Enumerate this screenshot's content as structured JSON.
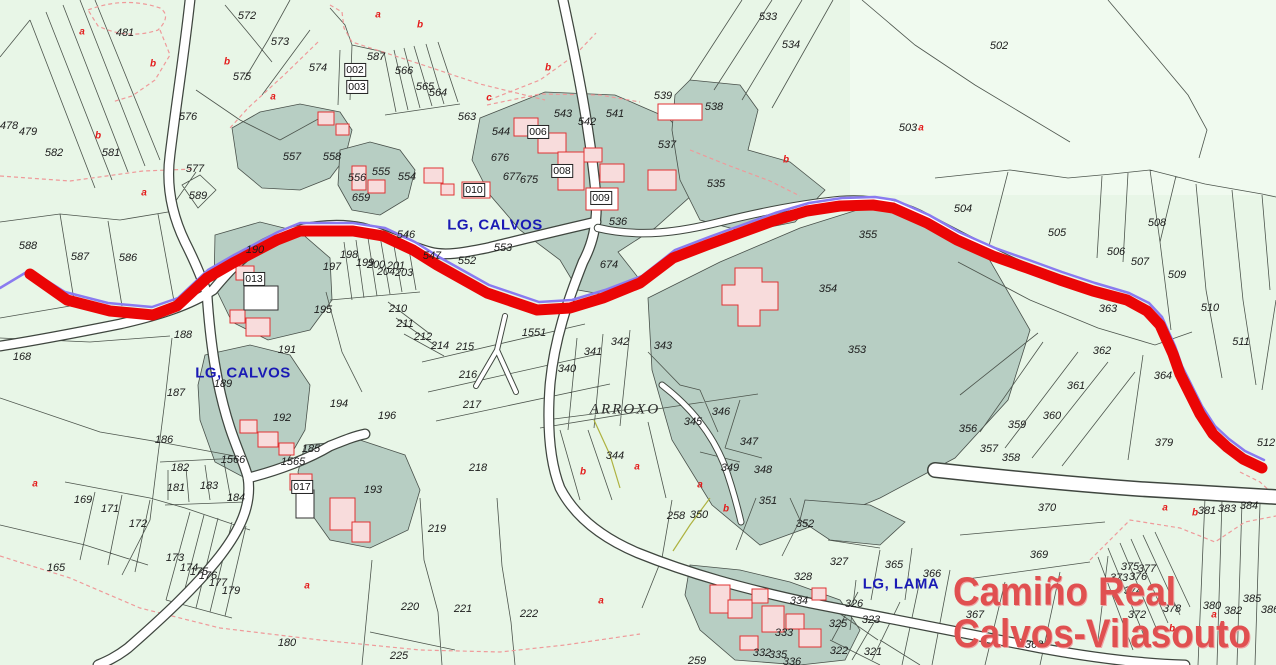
{
  "map": {
    "colors": {
      "background": "#e8f6e7",
      "parcel_shade": "#b7cec3",
      "building_fill": "#f8dcdc",
      "building_stroke": "#e03333",
      "route_red": "#eb0505",
      "route_purple": "#8a7bf0",
      "label_blue": "#1a1ab5",
      "title_red": "#e05050",
      "boundary": "#4d554d"
    },
    "title": {
      "line1": "Camiño Real",
      "line2": "Calvos-Vilasouto"
    },
    "labels": [
      {
        "t": "572",
        "x": 247,
        "y": 16,
        "k": "n"
      },
      {
        "t": "573",
        "x": 280,
        "y": 42,
        "k": "n"
      },
      {
        "t": "574",
        "x": 318,
        "y": 68,
        "k": "n"
      },
      {
        "t": "575",
        "x": 242,
        "y": 77,
        "k": "n"
      },
      {
        "t": "576",
        "x": 188,
        "y": 117,
        "k": "n"
      },
      {
        "t": "577",
        "x": 195,
        "y": 169,
        "k": "n"
      },
      {
        "t": "481",
        "x": 125,
        "y": 33,
        "k": "n"
      },
      {
        "t": "478",
        "x": 9,
        "y": 126,
        "k": "n"
      },
      {
        "t": "479",
        "x": 28,
        "y": 132,
        "k": "n"
      },
      {
        "t": "582",
        "x": 54,
        "y": 153,
        "k": "n"
      },
      {
        "t": "581",
        "x": 111,
        "y": 153,
        "k": "n"
      },
      {
        "t": "557",
        "x": 292,
        "y": 157,
        "k": "n"
      },
      {
        "t": "558",
        "x": 332,
        "y": 157,
        "k": "n"
      },
      {
        "t": "587",
        "x": 376,
        "y": 57,
        "k": "n"
      },
      {
        "t": "002",
        "x": 355,
        "y": 70,
        "k": "bx"
      },
      {
        "t": "003",
        "x": 357,
        "y": 87,
        "k": "bx"
      },
      {
        "t": "566",
        "x": 404,
        "y": 71,
        "k": "n"
      },
      {
        "t": "565",
        "x": 425,
        "y": 87,
        "k": "n"
      },
      {
        "t": "564",
        "x": 438,
        "y": 93,
        "k": "n"
      },
      {
        "t": "563",
        "x": 467,
        "y": 117,
        "k": "n"
      },
      {
        "t": "544",
        "x": 501,
        "y": 132,
        "k": "n"
      },
      {
        "t": "006",
        "x": 538,
        "y": 132,
        "k": "bx"
      },
      {
        "t": "543",
        "x": 563,
        "y": 114,
        "k": "n"
      },
      {
        "t": "542",
        "x": 587,
        "y": 122,
        "k": "n"
      },
      {
        "t": "541",
        "x": 615,
        "y": 114,
        "k": "n"
      },
      {
        "t": "539",
        "x": 663,
        "y": 96,
        "k": "n"
      },
      {
        "t": "538",
        "x": 714,
        "y": 107,
        "k": "n"
      },
      {
        "t": "537",
        "x": 667,
        "y": 145,
        "k": "n"
      },
      {
        "t": "533",
        "x": 768,
        "y": 17,
        "k": "n"
      },
      {
        "t": "534",
        "x": 791,
        "y": 45,
        "k": "n"
      },
      {
        "t": "503",
        "x": 908,
        "y": 128,
        "k": "n"
      },
      {
        "t": "502",
        "x": 999,
        "y": 46,
        "k": "n"
      },
      {
        "t": "535",
        "x": 716,
        "y": 184,
        "k": "n"
      },
      {
        "t": "536",
        "x": 618,
        "y": 222,
        "k": "n"
      },
      {
        "t": "676",
        "x": 500,
        "y": 158,
        "k": "n"
      },
      {
        "t": "677",
        "x": 512,
        "y": 177,
        "k": "n"
      },
      {
        "t": "675",
        "x": 529,
        "y": 180,
        "k": "n"
      },
      {
        "t": "008",
        "x": 562,
        "y": 171,
        "k": "bx"
      },
      {
        "t": "009",
        "x": 601,
        "y": 198,
        "k": "bx"
      },
      {
        "t": "010",
        "x": 474,
        "y": 190,
        "k": "bx"
      },
      {
        "t": "556",
        "x": 357,
        "y": 178,
        "k": "n"
      },
      {
        "t": "555",
        "x": 381,
        "y": 172,
        "k": "n"
      },
      {
        "t": "554",
        "x": 407,
        "y": 177,
        "k": "n"
      },
      {
        "t": "659",
        "x": 361,
        "y": 198,
        "k": "n"
      },
      {
        "t": "589",
        "x": 198,
        "y": 196,
        "k": "n"
      },
      {
        "t": "588",
        "x": 28,
        "y": 246,
        "k": "n"
      },
      {
        "t": "587",
        "x": 80,
        "y": 257,
        "k": "n"
      },
      {
        "t": "586",
        "x": 128,
        "y": 258,
        "k": "n"
      },
      {
        "t": "190",
        "x": 255,
        "y": 250,
        "k": "n"
      },
      {
        "t": "013",
        "x": 254,
        "y": 279,
        "k": "bx"
      },
      {
        "t": "546",
        "x": 406,
        "y": 235,
        "k": "n"
      },
      {
        "t": "553",
        "x": 503,
        "y": 248,
        "k": "n"
      },
      {
        "t": "547",
        "x": 432,
        "y": 256,
        "k": "n"
      },
      {
        "t": "552",
        "x": 467,
        "y": 261,
        "k": "n"
      },
      {
        "t": "198",
        "x": 349,
        "y": 255,
        "k": "n"
      },
      {
        "t": "199",
        "x": 365,
        "y": 263,
        "k": "n"
      },
      {
        "t": "200",
        "x": 376,
        "y": 265,
        "k": "n"
      },
      {
        "t": "201",
        "x": 396,
        "y": 266,
        "k": "n"
      },
      {
        "t": "204",
        "x": 386,
        "y": 272,
        "k": "n"
      },
      {
        "t": "203",
        "x": 404,
        "y": 273,
        "k": "n"
      },
      {
        "t": "197",
        "x": 332,
        "y": 267,
        "k": "n"
      },
      {
        "t": "195",
        "x": 323,
        "y": 310,
        "k": "n"
      },
      {
        "t": "674",
        "x": 609,
        "y": 265,
        "k": "n"
      },
      {
        "t": "355",
        "x": 868,
        "y": 235,
        "k": "n"
      },
      {
        "t": "354",
        "x": 828,
        "y": 289,
        "k": "n"
      },
      {
        "t": "504",
        "x": 963,
        "y": 209,
        "k": "n"
      },
      {
        "t": "505",
        "x": 1057,
        "y": 233,
        "k": "n"
      },
      {
        "t": "506",
        "x": 1116,
        "y": 252,
        "k": "n"
      },
      {
        "t": "507",
        "x": 1140,
        "y": 262,
        "k": "n"
      },
      {
        "t": "508",
        "x": 1157,
        "y": 223,
        "k": "n"
      },
      {
        "t": "509",
        "x": 1177,
        "y": 275,
        "k": "n"
      },
      {
        "t": "510",
        "x": 1210,
        "y": 308,
        "k": "n"
      },
      {
        "t": "511",
        "x": 1241,
        "y": 342,
        "k": "n"
      },
      {
        "t": "512",
        "x": 1266,
        "y": 443,
        "k": "n"
      },
      {
        "t": "363",
        "x": 1108,
        "y": 309,
        "k": "n"
      },
      {
        "t": "364",
        "x": 1163,
        "y": 376,
        "k": "n"
      },
      {
        "t": "362",
        "x": 1102,
        "y": 351,
        "k": "n"
      },
      {
        "t": "361",
        "x": 1076,
        "y": 386,
        "k": "n"
      },
      {
        "t": "360",
        "x": 1052,
        "y": 416,
        "k": "n"
      },
      {
        "t": "359",
        "x": 1017,
        "y": 425,
        "k": "n"
      },
      {
        "t": "356",
        "x": 968,
        "y": 429,
        "k": "n"
      },
      {
        "t": "357",
        "x": 989,
        "y": 449,
        "k": "n"
      },
      {
        "t": "358",
        "x": 1011,
        "y": 458,
        "k": "n"
      },
      {
        "t": "379",
        "x": 1164,
        "y": 443,
        "k": "n"
      },
      {
        "t": "353",
        "x": 857,
        "y": 350,
        "k": "n"
      },
      {
        "t": "343",
        "x": 663,
        "y": 346,
        "k": "n"
      },
      {
        "t": "1551",
        "x": 534,
        "y": 333,
        "k": "n"
      },
      {
        "t": "340",
        "x": 567,
        "y": 369,
        "k": "n"
      },
      {
        "t": "341",
        "x": 593,
        "y": 352,
        "k": "n"
      },
      {
        "t": "342",
        "x": 620,
        "y": 342,
        "k": "n"
      },
      {
        "t": "344",
        "x": 615,
        "y": 456,
        "k": "n"
      },
      {
        "t": "345",
        "x": 693,
        "y": 422,
        "k": "n"
      },
      {
        "t": "346",
        "x": 721,
        "y": 412,
        "k": "n"
      },
      {
        "t": "347",
        "x": 749,
        "y": 442,
        "k": "n"
      },
      {
        "t": "349",
        "x": 730,
        "y": 468,
        "k": "n"
      },
      {
        "t": "348",
        "x": 763,
        "y": 470,
        "k": "n"
      },
      {
        "t": "168",
        "x": 22,
        "y": 357,
        "k": "n"
      },
      {
        "t": "188",
        "x": 183,
        "y": 335,
        "k": "n"
      },
      {
        "t": "187",
        "x": 176,
        "y": 393,
        "k": "n"
      },
      {
        "t": "186",
        "x": 164,
        "y": 440,
        "k": "n"
      },
      {
        "t": "182",
        "x": 180,
        "y": 468,
        "k": "n"
      },
      {
        "t": "181",
        "x": 176,
        "y": 488,
        "k": "n"
      },
      {
        "t": "183",
        "x": 209,
        "y": 486,
        "k": "n"
      },
      {
        "t": "184",
        "x": 236,
        "y": 498,
        "k": "n"
      },
      {
        "t": "189",
        "x": 223,
        "y": 384,
        "k": "n"
      },
      {
        "t": "191",
        "x": 287,
        "y": 350,
        "k": "n"
      },
      {
        "t": "192",
        "x": 282,
        "y": 418,
        "k": "n"
      },
      {
        "t": "1566",
        "x": 233,
        "y": 460,
        "k": "n"
      },
      {
        "t": "1565",
        "x": 293,
        "y": 462,
        "k": "n"
      },
      {
        "t": "185",
        "x": 311,
        "y": 449,
        "k": "n"
      },
      {
        "t": "017",
        "x": 302,
        "y": 487,
        "k": "bx"
      },
      {
        "t": "194",
        "x": 339,
        "y": 404,
        "k": "n"
      },
      {
        "t": "196",
        "x": 387,
        "y": 416,
        "k": "n"
      },
      {
        "t": "193",
        "x": 373,
        "y": 490,
        "k": "n"
      },
      {
        "t": "210",
        "x": 398,
        "y": 309,
        "k": "n"
      },
      {
        "t": "211",
        "x": 405,
        "y": 324,
        "k": "n"
      },
      {
        "t": "212",
        "x": 423,
        "y": 337,
        "k": "n"
      },
      {
        "t": "214",
        "x": 440,
        "y": 346,
        "k": "n"
      },
      {
        "t": "215",
        "x": 465,
        "y": 347,
        "k": "n"
      },
      {
        "t": "216",
        "x": 468,
        "y": 375,
        "k": "n"
      },
      {
        "t": "217",
        "x": 472,
        "y": 405,
        "k": "n"
      },
      {
        "t": "218",
        "x": 478,
        "y": 468,
        "k": "n"
      },
      {
        "t": "219",
        "x": 437,
        "y": 529,
        "k": "n"
      },
      {
        "t": "220",
        "x": 410,
        "y": 607,
        "k": "n"
      },
      {
        "t": "221",
        "x": 463,
        "y": 609,
        "k": "n"
      },
      {
        "t": "222",
        "x": 529,
        "y": 614,
        "k": "n"
      },
      {
        "t": "225",
        "x": 399,
        "y": 656,
        "k": "n"
      },
      {
        "t": "169",
        "x": 83,
        "y": 500,
        "k": "n"
      },
      {
        "t": "171",
        "x": 110,
        "y": 509,
        "k": "n"
      },
      {
        "t": "172",
        "x": 138,
        "y": 524,
        "k": "n"
      },
      {
        "t": "165",
        "x": 56,
        "y": 568,
        "k": "n"
      },
      {
        "t": "173",
        "x": 175,
        "y": 558,
        "k": "n"
      },
      {
        "t": "174",
        "x": 189,
        "y": 568,
        "k": "n"
      },
      {
        "t": "175",
        "x": 199,
        "y": 572,
        "k": "n"
      },
      {
        "t": "176",
        "x": 208,
        "y": 576,
        "k": "n"
      },
      {
        "t": "177",
        "x": 218,
        "y": 583,
        "k": "n"
      },
      {
        "t": "179",
        "x": 231,
        "y": 591,
        "k": "n"
      },
      {
        "t": "180",
        "x": 287,
        "y": 643,
        "k": "n"
      },
      {
        "t": "350",
        "x": 699,
        "y": 515,
        "k": "n"
      },
      {
        "t": "351",
        "x": 768,
        "y": 501,
        "k": "n"
      },
      {
        "t": "352",
        "x": 805,
        "y": 524,
        "k": "n"
      },
      {
        "t": "327",
        "x": 839,
        "y": 562,
        "k": "n"
      },
      {
        "t": "328",
        "x": 803,
        "y": 577,
        "k": "n"
      },
      {
        "t": "334",
        "x": 799,
        "y": 601,
        "k": "n"
      },
      {
        "t": "326",
        "x": 854,
        "y": 604,
        "k": "n"
      },
      {
        "t": "365",
        "x": 894,
        "y": 565,
        "k": "n"
      },
      {
        "t": "366",
        "x": 932,
        "y": 574,
        "k": "n"
      },
      {
        "t": "323",
        "x": 871,
        "y": 620,
        "k": "n"
      },
      {
        "t": "325",
        "x": 838,
        "y": 624,
        "k": "n"
      },
      {
        "t": "322",
        "x": 839,
        "y": 651,
        "k": "n"
      },
      {
        "t": "321",
        "x": 873,
        "y": 652,
        "k": "n"
      },
      {
        "t": "333",
        "x": 784,
        "y": 633,
        "k": "n"
      },
      {
        "t": "332",
        "x": 762,
        "y": 653,
        "k": "n"
      },
      {
        "t": "335",
        "x": 778,
        "y": 655,
        "k": "n"
      },
      {
        "t": "336",
        "x": 792,
        "y": 662,
        "k": "n"
      },
      {
        "t": "258",
        "x": 676,
        "y": 516,
        "k": "n"
      },
      {
        "t": "259",
        "x": 697,
        "y": 661,
        "k": "n"
      },
      {
        "t": "370",
        "x": 1047,
        "y": 508,
        "k": "n"
      },
      {
        "t": "369",
        "x": 1039,
        "y": 555,
        "k": "n"
      },
      {
        "t": "367",
        "x": 975,
        "y": 615,
        "k": "n"
      },
      {
        "t": "368",
        "x": 1034,
        "y": 645,
        "k": "n"
      },
      {
        "t": "375",
        "x": 1130,
        "y": 567,
        "k": "n"
      },
      {
        "t": "377",
        "x": 1147,
        "y": 569,
        "k": "n"
      },
      {
        "t": "376",
        "x": 1138,
        "y": 577,
        "k": "n"
      },
      {
        "t": "373",
        "x": 1119,
        "y": 578,
        "k": "n"
      },
      {
        "t": "374",
        "x": 1133,
        "y": 591,
        "k": "n"
      },
      {
        "t": "372",
        "x": 1137,
        "y": 615,
        "k": "n"
      },
      {
        "t": "378",
        "x": 1172,
        "y": 609,
        "k": "n"
      },
      {
        "t": "380",
        "x": 1212,
        "y": 606,
        "k": "n"
      },
      {
        "t": "382",
        "x": 1233,
        "y": 611,
        "k": "n"
      },
      {
        "t": "385",
        "x": 1252,
        "y": 599,
        "k": "n"
      },
      {
        "t": "381",
        "x": 1207,
        "y": 511,
        "k": "n"
      },
      {
        "t": "383",
        "x": 1227,
        "y": 509,
        "k": "n"
      },
      {
        "t": "384",
        "x": 1249,
        "y": 506,
        "k": "n"
      },
      {
        "t": "386",
        "x": 1270,
        "y": 610,
        "k": "n"
      },
      {
        "t": "a",
        "x": 82,
        "y": 32,
        "k": "r"
      },
      {
        "t": "b",
        "x": 153,
        "y": 64,
        "k": "r"
      },
      {
        "t": "b",
        "x": 227,
        "y": 62,
        "k": "r"
      },
      {
        "t": "a",
        "x": 273,
        "y": 97,
        "k": "r"
      },
      {
        "t": "b",
        "x": 98,
        "y": 136,
        "k": "r"
      },
      {
        "t": "a",
        "x": 378,
        "y": 15,
        "k": "r"
      },
      {
        "t": "b",
        "x": 420,
        "y": 25,
        "k": "r"
      },
      {
        "t": "b",
        "x": 548,
        "y": 68,
        "k": "r"
      },
      {
        "t": "c",
        "x": 489,
        "y": 98,
        "k": "r"
      },
      {
        "t": "a",
        "x": 921,
        "y": 128,
        "k": "r"
      },
      {
        "t": "b",
        "x": 786,
        "y": 160,
        "k": "r"
      },
      {
        "t": "a",
        "x": 144,
        "y": 193,
        "k": "r"
      },
      {
        "t": "a",
        "x": 35,
        "y": 484,
        "k": "r"
      },
      {
        "t": "b",
        "x": 583,
        "y": 472,
        "k": "r"
      },
      {
        "t": "a",
        "x": 637,
        "y": 467,
        "k": "r"
      },
      {
        "t": "a",
        "x": 700,
        "y": 485,
        "k": "r"
      },
      {
        "t": "a",
        "x": 601,
        "y": 601,
        "k": "r"
      },
      {
        "t": "b",
        "x": 726,
        "y": 509,
        "k": "r"
      },
      {
        "t": "a",
        "x": 307,
        "y": 586,
        "k": "r"
      },
      {
        "t": "a",
        "x": 1165,
        "y": 508,
        "k": "r"
      },
      {
        "t": "b",
        "x": 1195,
        "y": 513,
        "k": "r"
      },
      {
        "t": "a",
        "x": 1214,
        "y": 615,
        "k": "r"
      },
      {
        "t": "b",
        "x": 1172,
        "y": 629,
        "k": "r"
      },
      {
        "t": "LG, CALVOS",
        "x": 495,
        "y": 225,
        "k": "p"
      },
      {
        "t": "LG, CALVOS",
        "x": 243,
        "y": 373,
        "k": "p"
      },
      {
        "t": "LG, LAMA",
        "x": 901,
        "y": 584,
        "k": "p"
      },
      {
        "t": "ARROXO",
        "x": 625,
        "y": 410,
        "k": "t"
      }
    ]
  }
}
